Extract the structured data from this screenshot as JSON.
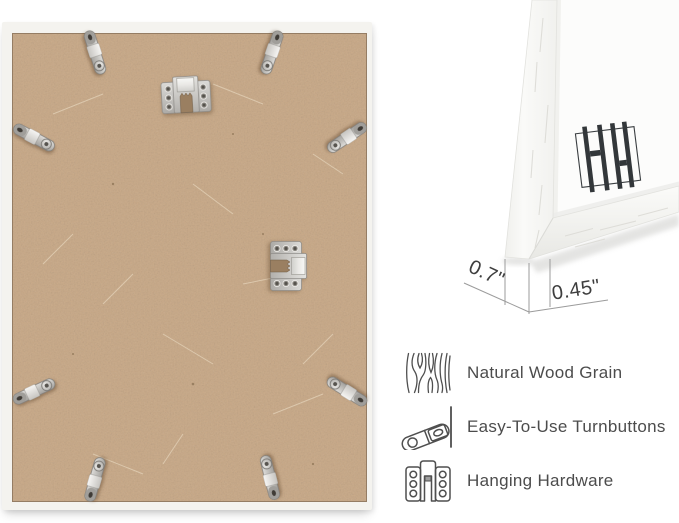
{
  "colors": {
    "background": "#ffffff",
    "mdf_board": "#cdae8e",
    "frame_white": "#f4f3ef",
    "metal_silver": "#c9c9c7",
    "annotation_text": "#3e3e3e",
    "dimension_line": "#9b9b9b",
    "feature_text": "#4c4c4c",
    "icon_stroke": "#4f4f4f",
    "logo_mark": "#33373a"
  },
  "back_view": {
    "turnbutton_count": 8,
    "hangers": [
      "sawtooth-hanger-top",
      "sawtooth-hanger-side"
    ]
  },
  "corner_view": {
    "logo": "brand-logo-monogram",
    "measurements": [
      {
        "name": "frame-depth",
        "label": "0.7\""
      },
      {
        "name": "frame-face-width",
        "label": "0.45\""
      }
    ]
  },
  "features": [
    {
      "icon": "wood-grain-icon",
      "label": "Natural Wood Grain"
    },
    {
      "icon": "turnbutton-icon",
      "label": "Easy-To-Use Turnbuttons"
    },
    {
      "icon": "hanging-hardware-icon",
      "label": "Hanging Hardware"
    }
  ]
}
